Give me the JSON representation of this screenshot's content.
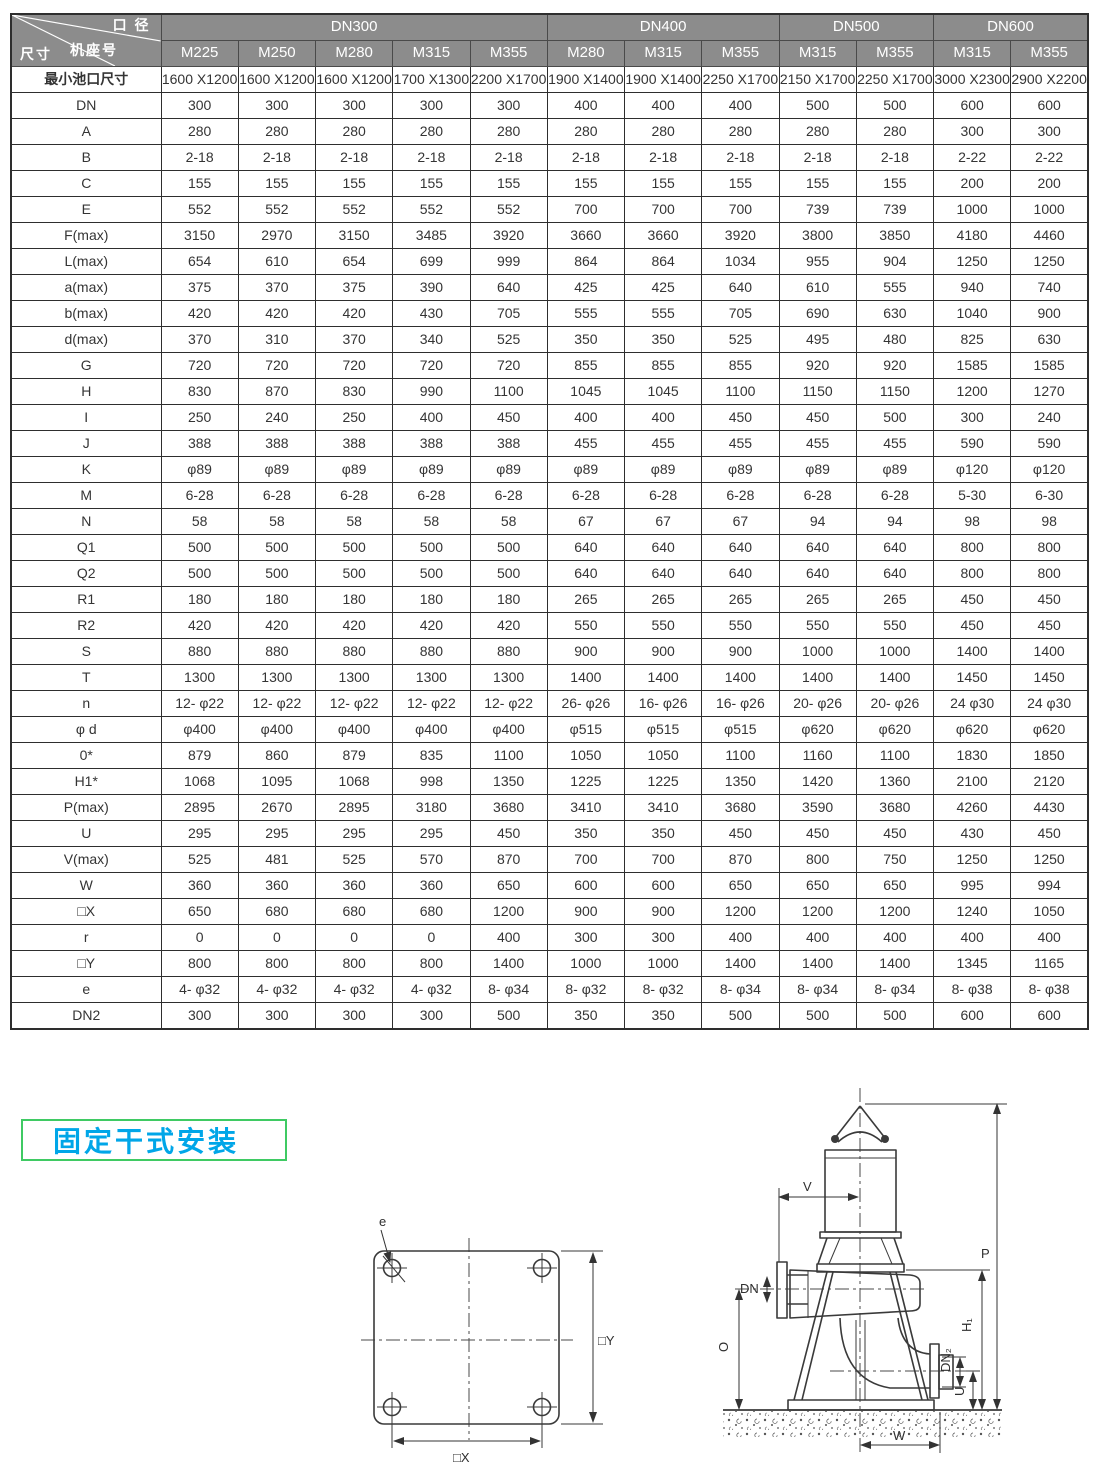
{
  "page": {
    "background": "#ffffff"
  },
  "colors": {
    "header_bg": "#8c8c8c",
    "header_text": "#ffffff",
    "grid": "#2e2e2e",
    "value_text": "#343434",
    "section_label_text": "#00a6e8",
    "section_label_border": "#3fca63",
    "drawing_stroke": "#3a3a3a"
  },
  "table": {
    "corner": {
      "top": "口 径",
      "middle": "机座号",
      "bottom": "尺寸"
    },
    "groups": [
      {
        "label": "DN300",
        "span": 5
      },
      {
        "label": "DN400",
        "span": 3
      },
      {
        "label": "DN500",
        "span": 2
      },
      {
        "label": "DN600",
        "span": 2
      }
    ],
    "frames": [
      "M225",
      "M250",
      "M280",
      "M315",
      "M355",
      "M280",
      "M315",
      "M355",
      "M315",
      "M355",
      "M315",
      "M355"
    ],
    "min_pit": {
      "label": "最小池口尺寸",
      "values": [
        "1600\nX1200",
        "1600\nX1200",
        "1600\nX1200",
        "1700\nX1300",
        "2200\nX1700",
        "1900\nX1400",
        "1900\nX1400",
        "2250\nX1700",
        "2150\nX1700",
        "2250\nX1700",
        "3000\nX2300",
        "2900\nX2200"
      ]
    },
    "rows": [
      {
        "label": "DN",
        "values": [
          "300",
          "300",
          "300",
          "300",
          "300",
          "400",
          "400",
          "400",
          "500",
          "500",
          "600",
          "600"
        ]
      },
      {
        "label": "A",
        "values": [
          "280",
          "280",
          "280",
          "280",
          "280",
          "280",
          "280",
          "280",
          "280",
          "280",
          "300",
          "300"
        ]
      },
      {
        "label": "B",
        "values": [
          "2-18",
          "2-18",
          "2-18",
          "2-18",
          "2-18",
          "2-18",
          "2-18",
          "2-18",
          "2-18",
          "2-18",
          "2-22",
          "2-22"
        ]
      },
      {
        "label": "C",
        "values": [
          "155",
          "155",
          "155",
          "155",
          "155",
          "155",
          "155",
          "155",
          "155",
          "155",
          "200",
          "200"
        ]
      },
      {
        "label": "E",
        "values": [
          "552",
          "552",
          "552",
          "552",
          "552",
          "700",
          "700",
          "700",
          "739",
          "739",
          "1000",
          "1000"
        ]
      },
      {
        "label": "F(max)",
        "values": [
          "3150",
          "2970",
          "3150",
          "3485",
          "3920",
          "3660",
          "3660",
          "3920",
          "3800",
          "3850",
          "4180",
          "4460"
        ]
      },
      {
        "label": "L(max)",
        "values": [
          "654",
          "610",
          "654",
          "699",
          "999",
          "864",
          "864",
          "1034",
          "955",
          "904",
          "1250",
          "1250"
        ]
      },
      {
        "label": "a(max)",
        "values": [
          "375",
          "370",
          "375",
          "390",
          "640",
          "425",
          "425",
          "640",
          "610",
          "555",
          "940",
          "740"
        ]
      },
      {
        "label": "b(max)",
        "values": [
          "420",
          "420",
          "420",
          "430",
          "705",
          "555",
          "555",
          "705",
          "690",
          "630",
          "1040",
          "900"
        ]
      },
      {
        "label": "d(max)",
        "values": [
          "370",
          "310",
          "370",
          "340",
          "525",
          "350",
          "350",
          "525",
          "495",
          "480",
          "825",
          "630"
        ]
      },
      {
        "label": "G",
        "values": [
          "720",
          "720",
          "720",
          "720",
          "720",
          "855",
          "855",
          "855",
          "920",
          "920",
          "1585",
          "1585"
        ]
      },
      {
        "label": "H",
        "values": [
          "830",
          "870",
          "830",
          "990",
          "1100",
          "1045",
          "1045",
          "1100",
          "1150",
          "1150",
          "1200",
          "1270"
        ]
      },
      {
        "label": "I",
        "values": [
          "250",
          "240",
          "250",
          "400",
          "450",
          "400",
          "400",
          "450",
          "450",
          "500",
          "300",
          "240"
        ]
      },
      {
        "label": "J",
        "values": [
          "388",
          "388",
          "388",
          "388",
          "388",
          "455",
          "455",
          "455",
          "455",
          "455",
          "590",
          "590"
        ]
      },
      {
        "label": "K",
        "values": [
          "φ89",
          "φ89",
          "φ89",
          "φ89",
          "φ89",
          "φ89",
          "φ89",
          "φ89",
          "φ89",
          "φ89",
          "φ120",
          "φ120"
        ]
      },
      {
        "label": "M",
        "values": [
          "6-28",
          "6-28",
          "6-28",
          "6-28",
          "6-28",
          "6-28",
          "6-28",
          "6-28",
          "6-28",
          "6-28",
          "5-30",
          "6-30"
        ]
      },
      {
        "label": "N",
        "values": [
          "58",
          "58",
          "58",
          "58",
          "58",
          "67",
          "67",
          "67",
          "94",
          "94",
          "98",
          "98"
        ]
      },
      {
        "label": "Q1",
        "values": [
          "500",
          "500",
          "500",
          "500",
          "500",
          "640",
          "640",
          "640",
          "640",
          "640",
          "800",
          "800"
        ]
      },
      {
        "label": "Q2",
        "values": [
          "500",
          "500",
          "500",
          "500",
          "500",
          "640",
          "640",
          "640",
          "640",
          "640",
          "800",
          "800"
        ]
      },
      {
        "label": "R1",
        "values": [
          "180",
          "180",
          "180",
          "180",
          "180",
          "265",
          "265",
          "265",
          "265",
          "265",
          "450",
          "450"
        ]
      },
      {
        "label": "R2",
        "values": [
          "420",
          "420",
          "420",
          "420",
          "420",
          "550",
          "550",
          "550",
          "550",
          "550",
          "450",
          "450"
        ]
      },
      {
        "label": "S",
        "values": [
          "880",
          "880",
          "880",
          "880",
          "880",
          "900",
          "900",
          "900",
          "1000",
          "1000",
          "1400",
          "1400"
        ]
      },
      {
        "label": "T",
        "values": [
          "1300",
          "1300",
          "1300",
          "1300",
          "1300",
          "1400",
          "1400",
          "1400",
          "1400",
          "1400",
          "1450",
          "1450"
        ]
      },
      {
        "label": "n",
        "values": [
          "12- φ22",
          "12- φ22",
          "12- φ22",
          "12- φ22",
          "12- φ22",
          "26- φ26",
          "16- φ26",
          "16- φ26",
          "20- φ26",
          "20- φ26",
          "24 φ30",
          "24 φ30"
        ]
      },
      {
        "label": "φ d",
        "values": [
          "φ400",
          "φ400",
          "φ400",
          "φ400",
          "φ400",
          "φ515",
          "φ515",
          "φ515",
          "φ620",
          "φ620",
          "φ620",
          "φ620"
        ]
      },
      {
        "label": "0*",
        "values": [
          "879",
          "860",
          "879",
          "835",
          "1100",
          "1050",
          "1050",
          "1100",
          "1160",
          "1100",
          "1830",
          "1850"
        ]
      },
      {
        "label": "H1*",
        "values": [
          "1068",
          "1095",
          "1068",
          "998",
          "1350",
          "1225",
          "1225",
          "1350",
          "1420",
          "1360",
          "2100",
          "2120"
        ]
      },
      {
        "label": "P(max)",
        "values": [
          "2895",
          "2670",
          "2895",
          "3180",
          "3680",
          "3410",
          "3410",
          "3680",
          "3590",
          "3680",
          "4260",
          "4430"
        ]
      },
      {
        "label": "U",
        "values": [
          "295",
          "295",
          "295",
          "295",
          "450",
          "350",
          "350",
          "450",
          "450",
          "450",
          "430",
          "450"
        ]
      },
      {
        "label": "V(max)",
        "values": [
          "525",
          "481",
          "525",
          "570",
          "870",
          "700",
          "700",
          "870",
          "800",
          "750",
          "1250",
          "1250"
        ]
      },
      {
        "label": "W",
        "values": [
          "360",
          "360",
          "360",
          "360",
          "650",
          "600",
          "600",
          "650",
          "650",
          "650",
          "995",
          "994"
        ]
      },
      {
        "label": "□X",
        "values": [
          "650",
          "680",
          "680",
          "680",
          "1200",
          "900",
          "900",
          "1200",
          "1200",
          "1200",
          "1240",
          "1050"
        ]
      },
      {
        "label": "r",
        "values": [
          "0",
          "0",
          "0",
          "0",
          "400",
          "300",
          "300",
          "400",
          "400",
          "400",
          "400",
          "400"
        ]
      },
      {
        "label": "□Y",
        "values": [
          "800",
          "800",
          "800",
          "800",
          "1400",
          "1000",
          "1000",
          "1400",
          "1400",
          "1400",
          "1345",
          "1165"
        ]
      },
      {
        "label": "e",
        "values": [
          "4- φ32",
          "4- φ32",
          "4- φ32",
          "4- φ32",
          "8- φ34",
          "8- φ32",
          "8- φ32",
          "8- φ34",
          "8- φ34",
          "8- φ34",
          "8- φ38",
          "8- φ38"
        ]
      },
      {
        "label": "DN2",
        "values": [
          "300",
          "300",
          "300",
          "300",
          "500",
          "350",
          "350",
          "500",
          "500",
          "500",
          "600",
          "600"
        ]
      }
    ]
  },
  "section": {
    "label": "固定干式安装"
  },
  "left_drawing": {
    "dims": {
      "e": "e",
      "y": "□Y",
      "x": "□X"
    }
  },
  "right_drawing": {
    "dims": {
      "v": "V",
      "p": "P",
      "dn": "DN",
      "o": "O",
      "h1": "H₁",
      "dn2": "DN₂",
      "u": "U",
      "w": "W"
    }
  }
}
